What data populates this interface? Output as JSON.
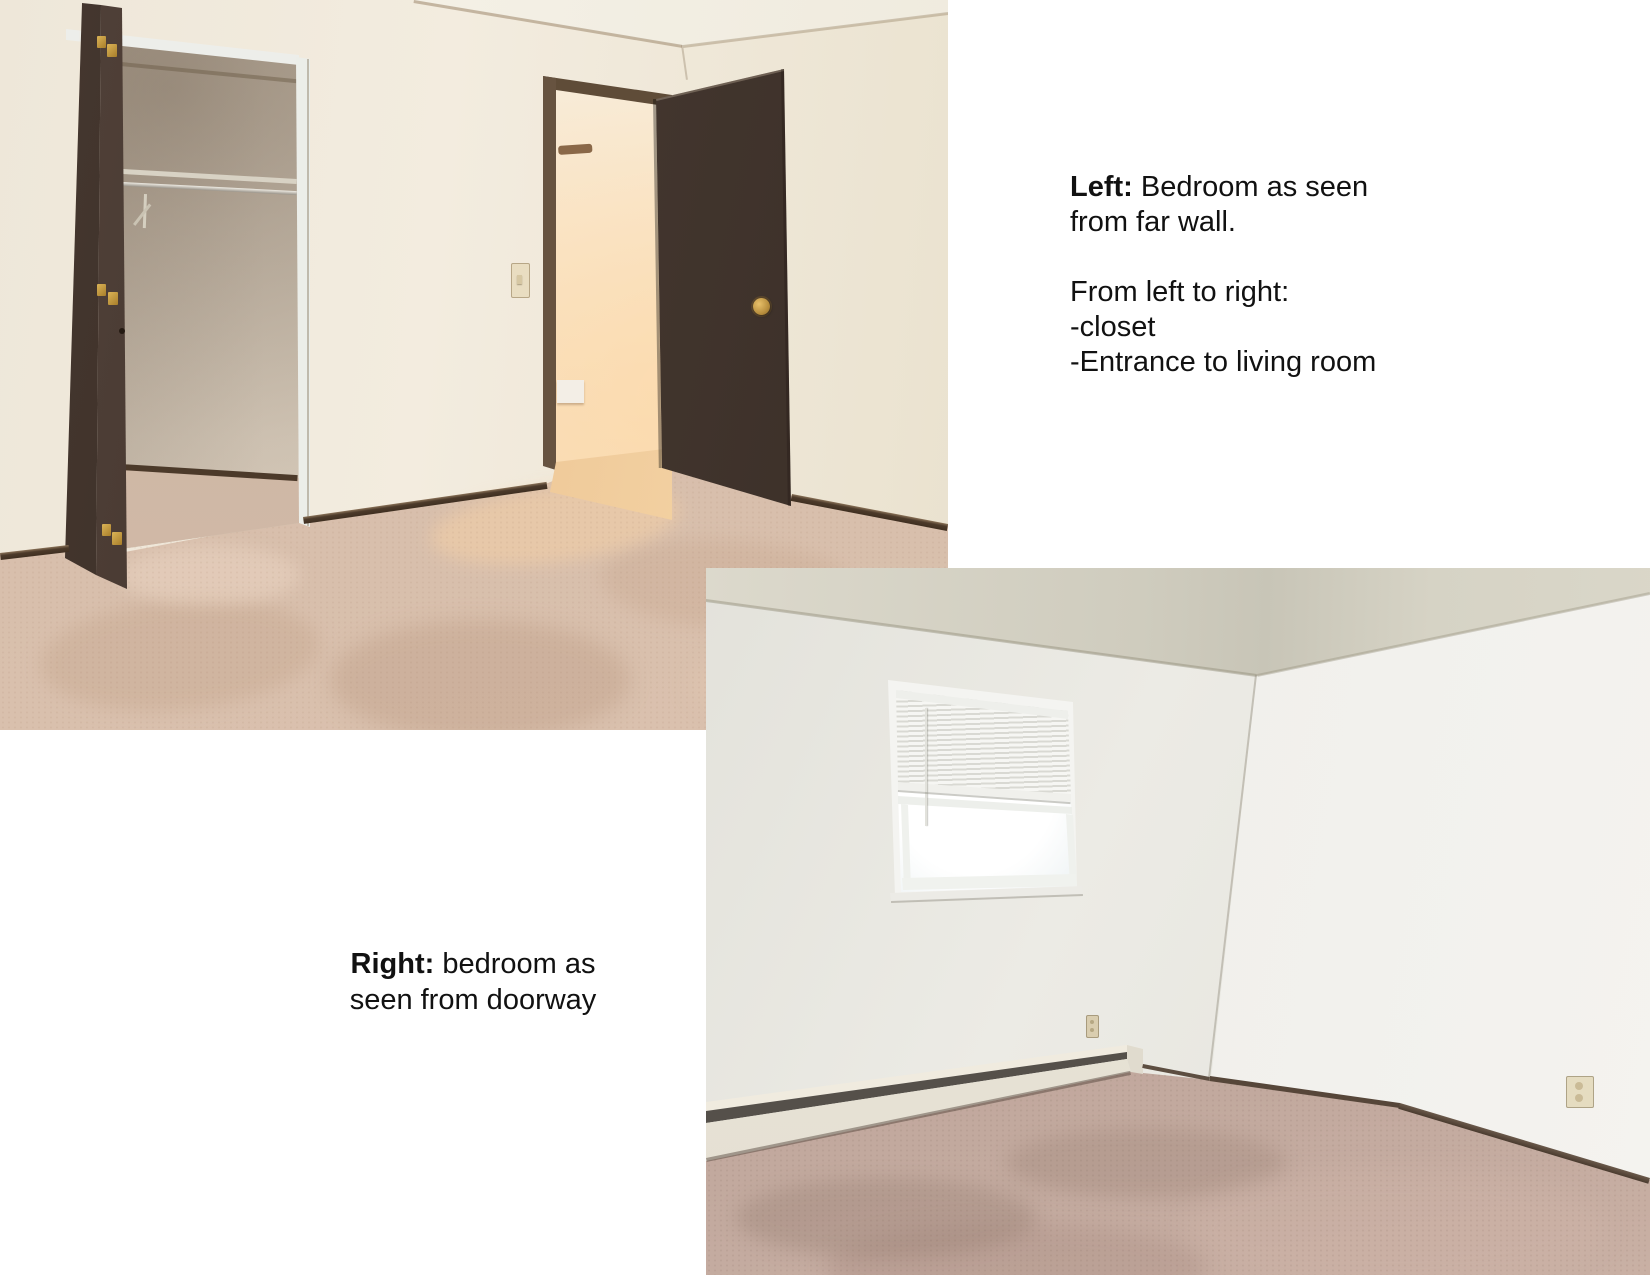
{
  "page": {
    "background": "#ffffff"
  },
  "captions": {
    "left_photo": {
      "bold": "Left:",
      "line1_rest": " Bedroom as seen",
      "line2": "from far wall.",
      "line4": "From left to right:",
      "line5": "-closet",
      "line6": "-Entrance to living room"
    },
    "right_photo": {
      "bold": "Right:",
      "line1_rest": " bedroom as",
      "line2": "seen from doorway"
    }
  },
  "palette": {
    "page-bg": "#ffffff",
    "wall-cream": "#efe8da",
    "wall-white": "#ebeae4",
    "ceiling-gray": "#cfccbe",
    "door-brown": "#46382f",
    "trim-brown": "#5f4c38",
    "closet-greige": "#cfc2b1",
    "carpet-tan": "#d8c1ae",
    "carpet-mauve": "#bca398",
    "brass": "#c79d3e",
    "baseboard-dark": "#4c3a2a",
    "heater-cream": "#ece7da",
    "glow-peach": "#f6dfc0"
  }
}
